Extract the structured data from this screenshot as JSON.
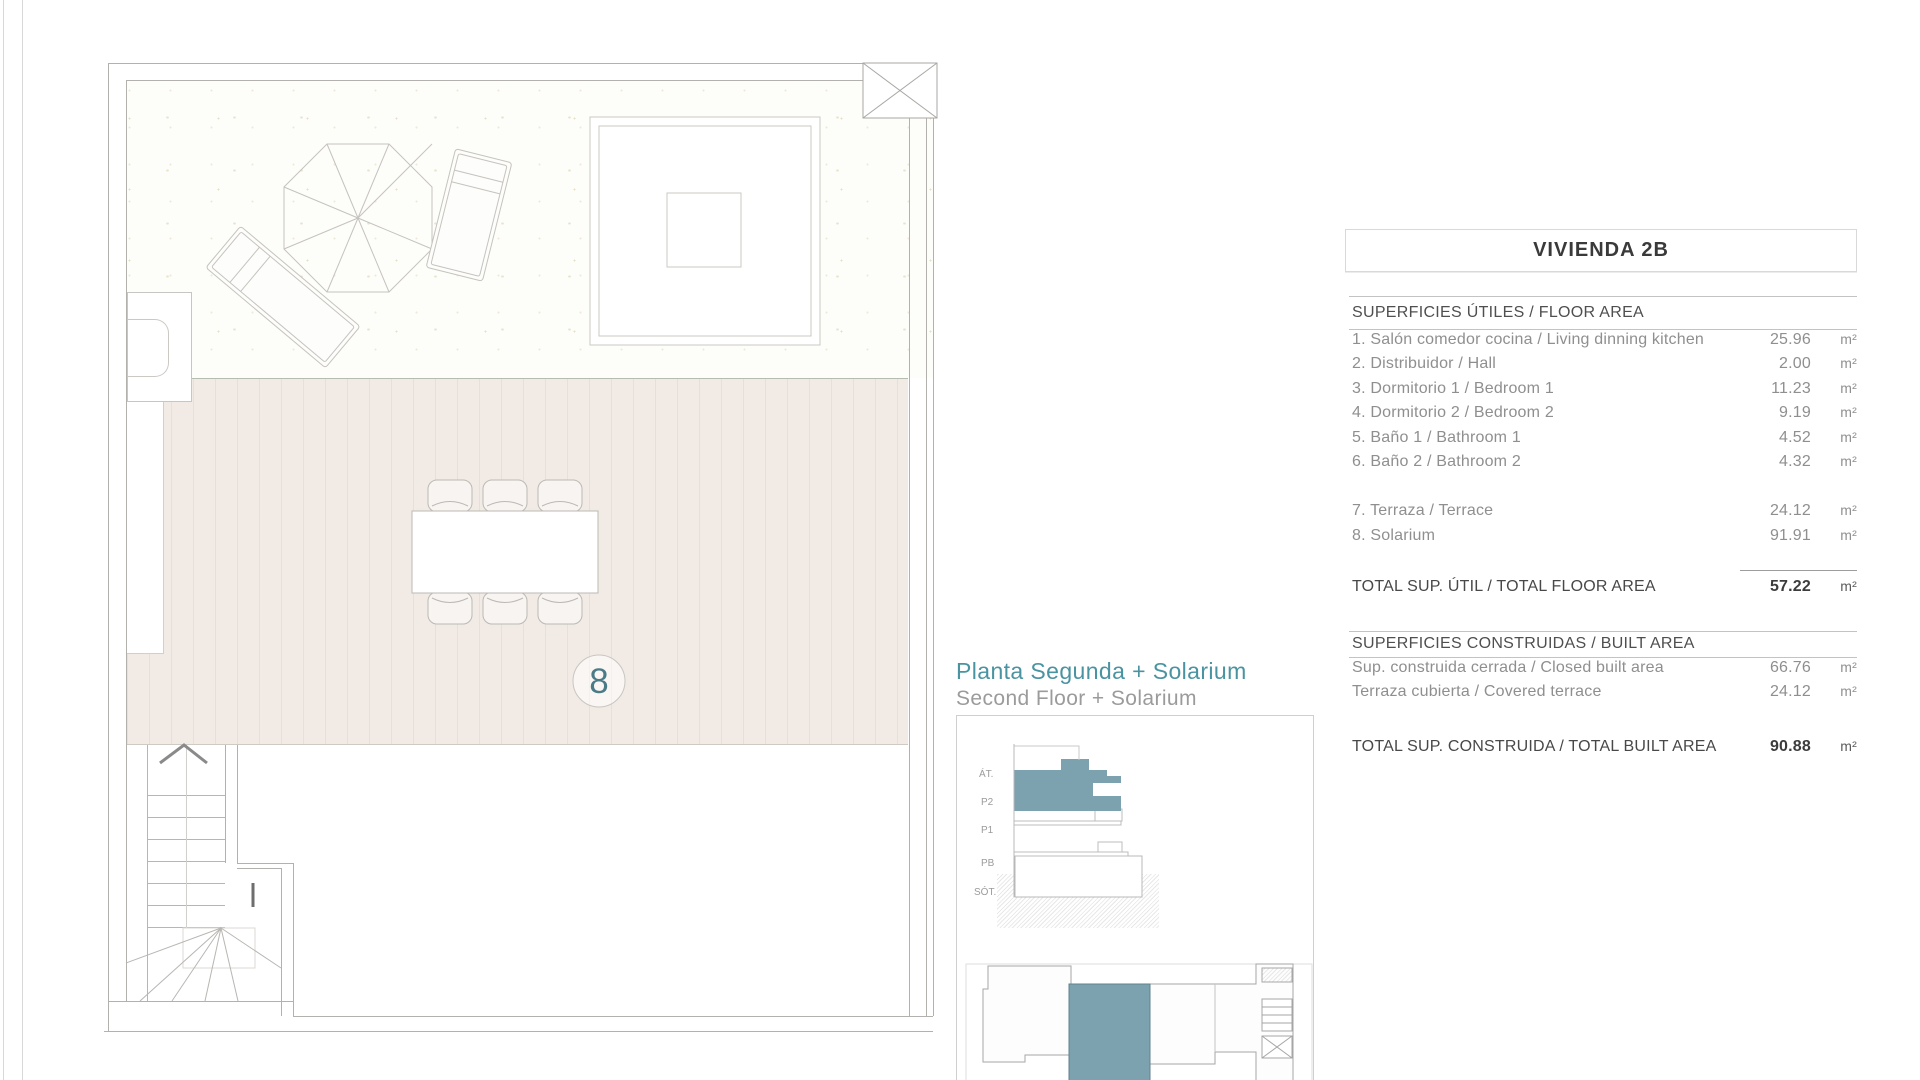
{
  "plan": {
    "unit_number": "8"
  },
  "panel": {
    "title": "VIVIENDA 2B",
    "floor_area": {
      "header": "SUPERFICIES ÚTILES / FLOOR AREA",
      "rows": [
        {
          "label": "1. Salón comedor cocina / Living dinning kitchen",
          "value": "25.96",
          "unit": "m²"
        },
        {
          "label": "2. Distribuidor / Hall",
          "value": "2.00",
          "unit": "m²"
        },
        {
          "label": "3. Dormitorio 1 / Bedroom 1",
          "value": "11.23",
          "unit": "m²"
        },
        {
          "label": "4. Dormitorio 2 / Bedroom 2",
          "value": "9.19",
          "unit": "m²"
        },
        {
          "label": "5. Baño 1 / Bathroom 1",
          "value": "4.52",
          "unit": "m²"
        },
        {
          "label": "6. Baño 2 / Bathroom 2",
          "value": "4.32",
          "unit": "m²"
        },
        {
          "label": "7. Terraza / Terrace",
          "value": "24.12",
          "unit": "m²"
        },
        {
          "label": "8. Solarium",
          "value": "91.91",
          "unit": "m²"
        }
      ],
      "total_label": "TOTAL SUP. ÚTIL / TOTAL FLOOR AREA",
      "total_value": "57.22",
      "total_unit": "m²"
    },
    "built_area": {
      "header": "SUPERFICIES CONSTRUIDAS / BUILT AREA",
      "rows": [
        {
          "label": "Sup. construida cerrada / Closed built area",
          "value": "66.76",
          "unit": "m²"
        },
        {
          "label": "Terraza cubierta / Covered terrace",
          "value": "24.12",
          "unit": "m²"
        }
      ],
      "total_label": "TOTAL SUP. CONSTRUIDA /  TOTAL BUILT AREA",
      "total_value": "90.88",
      "total_unit": "m²"
    }
  },
  "caption": {
    "title": "Planta Segunda + Solarium",
    "subtitle": "Second Floor + Solarium"
  },
  "section_key": {
    "floors": [
      "ÁT.",
      "P2",
      "P1",
      "PB",
      "SÓT."
    ]
  },
  "colors": {
    "accent_teal": "#4a93a1",
    "highlight_blue": "#7ca1af",
    "band_pink": "#f1eae5"
  }
}
